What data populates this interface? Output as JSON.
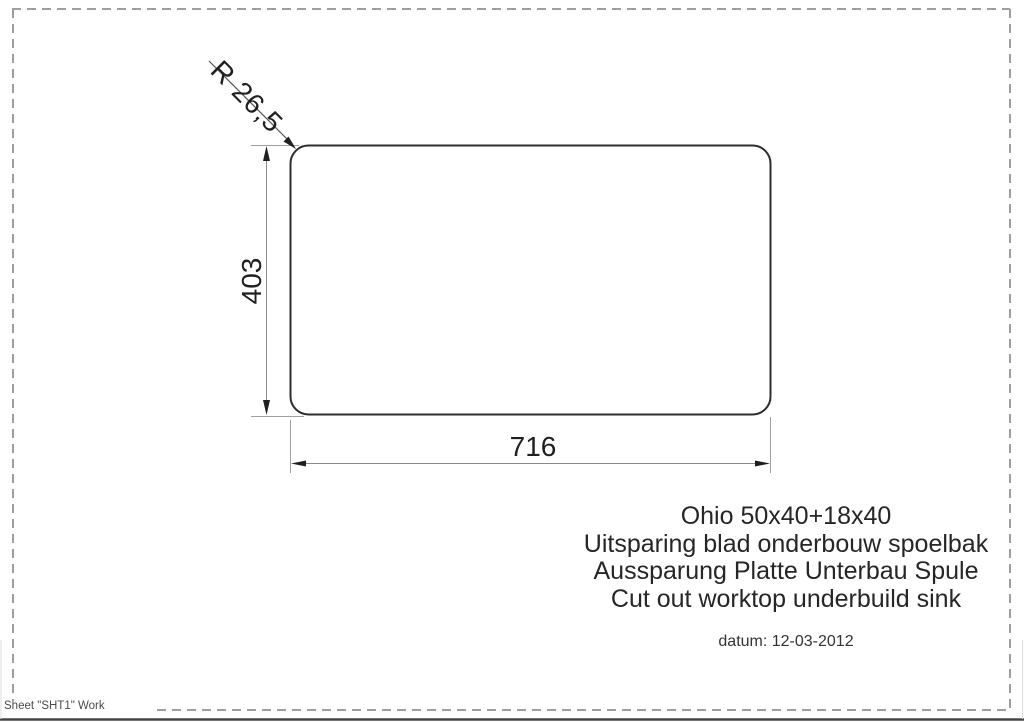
{
  "drawing": {
    "shape": "rounded-rectangle-cutout",
    "dimensions": {
      "corner_radius_label": "R 26,5",
      "height_label": "403",
      "width_label": "716"
    }
  },
  "title_block": {
    "lines": [
      "Ohio 50x40+18x40",
      "Uitsparing blad onderbouw spoelbak",
      "Aussparung Platte Unterbau Spule",
      "Cut out worktop underbuild sink"
    ],
    "date": "datum: 12-03-2012"
  },
  "footer": {
    "sheet_label": "Sheet \"SHT1\" Work"
  },
  "colors": {
    "outline": "#2d2d2d",
    "dimension_line": "#8a8a8a",
    "extension_line": "#a0a0a0",
    "arrow_and_text": "#1f1f1f",
    "border_dash": "#9e9e9e",
    "window_edge": "#454545"
  }
}
